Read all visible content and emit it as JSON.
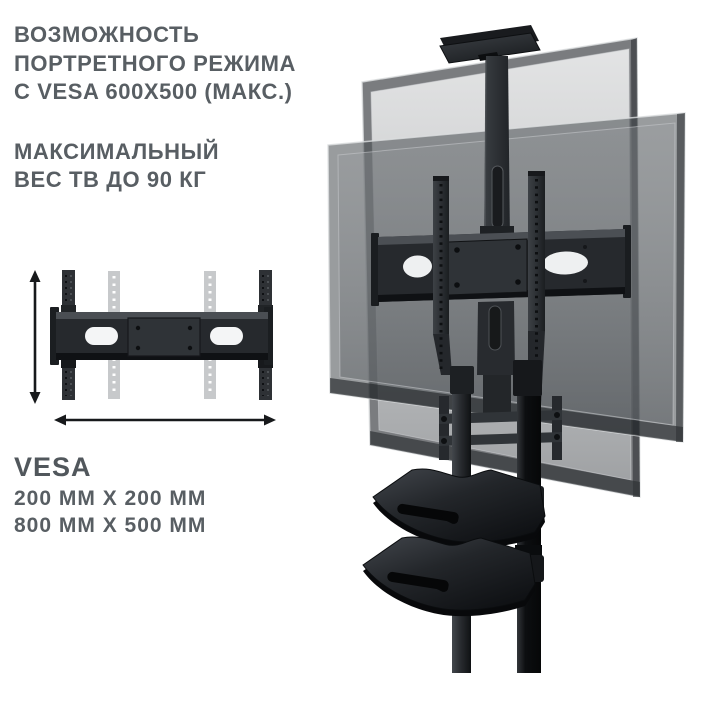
{
  "annotations": {
    "portrait_feature": {
      "line1": "ВОЗМОЖНОСТЬ",
      "line2": "ПОРТРЕТНОГО РЕЖИМА",
      "line3": "С VESA 600X500 (МАКС.)"
    },
    "weight_feature": {
      "line1": "МАКСИМАЛЬНЫЙ",
      "line2": "ВЕС ТВ ДО 90 КГ"
    },
    "vesa_spec": {
      "title": "VESA",
      "size1": "200 ММ X 200 ММ",
      "size2": "800 ММ X 500 ММ"
    }
  },
  "icons": {
    "height_arrow": "double-headed-vertical-dimension-arrow",
    "width_arrow": "double-headed-horizontal-dimension-arrow"
  },
  "colors": {
    "background": "#ffffff",
    "text": "#585e63",
    "arrow": "#17191b",
    "stand_dark": "#26292d",
    "stand_black": "#0c0e10",
    "screen_bezel": "#6e7276",
    "screen_glass_light": "#c8cacc",
    "screen_glass_dark": "#a4a7aa",
    "ghost_rail": "#c7c9cb"
  }
}
